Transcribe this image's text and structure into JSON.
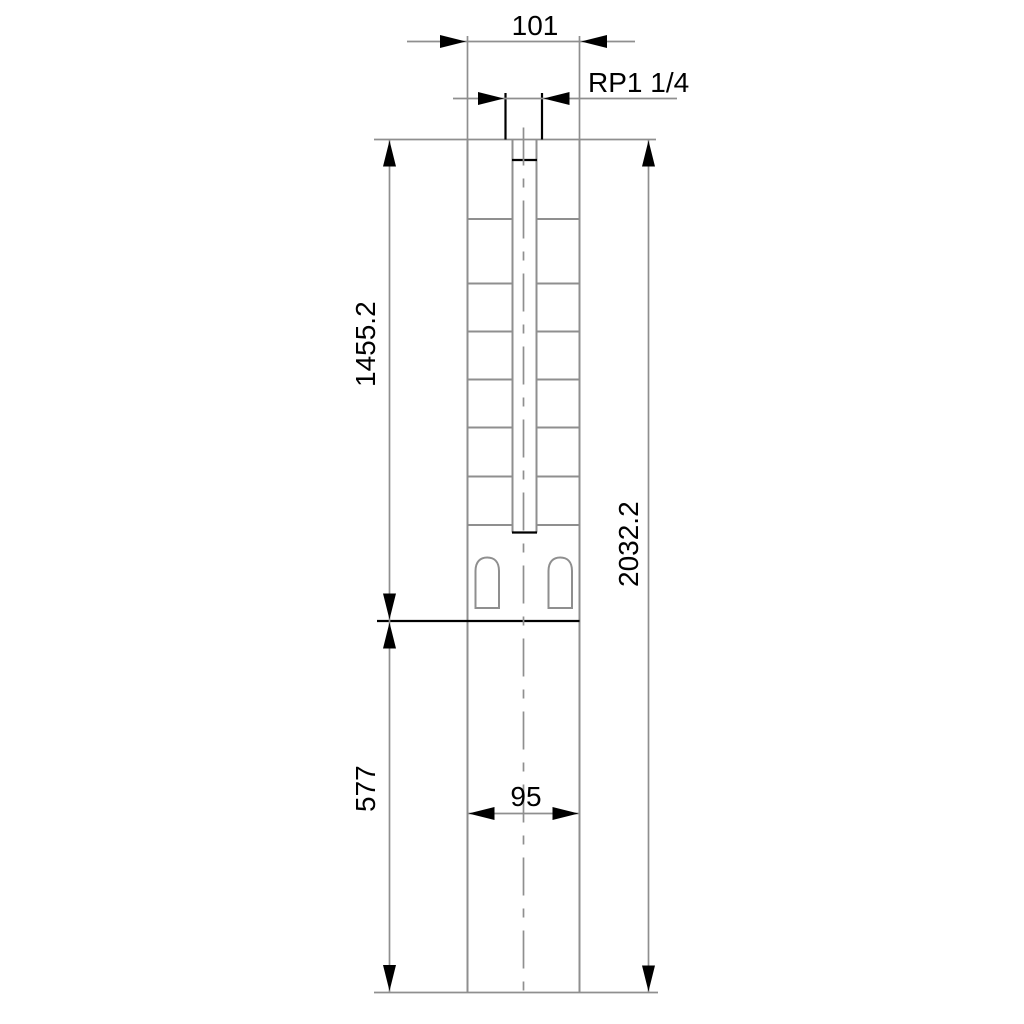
{
  "drawing": {
    "type": "technical-dimension-drawing",
    "dimensions": {
      "top_width": "101",
      "thread": "RP1 1/4",
      "pump_length": "1455.2",
      "total_length": "2032.2",
      "motor_length": "577",
      "motor_width": "95"
    },
    "colors": {
      "line_gray": "#8f8f8f",
      "ink": "#000000",
      "background": "#ffffff"
    }
  }
}
